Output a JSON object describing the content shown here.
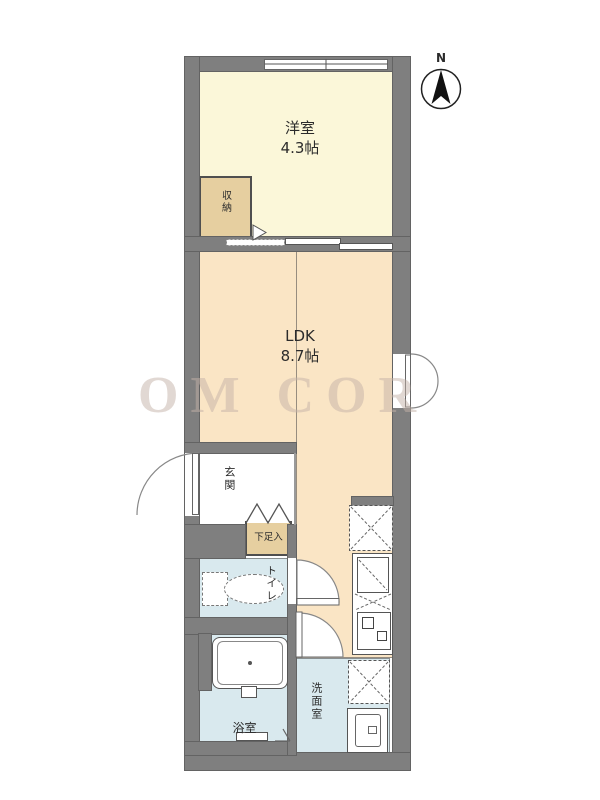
{
  "title": "apartment-floor-plan",
  "compass": {
    "north_label": "N"
  },
  "watermark": {
    "text": "OM COR"
  },
  "rooms": {
    "western_room": {
      "name": "洋室",
      "size": "4.3帖"
    },
    "ldk": {
      "name": "LDK",
      "size": "8.7帖"
    },
    "storage": {
      "name": "収納"
    },
    "shoe_box": {
      "name": "下足入"
    },
    "entrance": {
      "name": "玄関"
    },
    "toilet": {
      "name": "トイレ"
    },
    "bathroom": {
      "name": "浴室"
    },
    "washroom": {
      "name": "洗面室"
    }
  },
  "icons": [
    "compass-icon",
    "toilet-fixture",
    "bathtub-fixture",
    "kitchen-sink",
    "stove-fixture",
    "refrigerator-space",
    "washing-machine-space",
    "vanity-fixture",
    "door-swing",
    "window",
    "folding-door",
    "storage-door-marker"
  ],
  "colors": {
    "wall": "#7f7f7f",
    "western_room": "#FBF7D9",
    "ldk": "#FAE5C5",
    "storage": "#E6CFA0",
    "wet_area": "#D9E9EE",
    "watermark": "#C4B2A8"
  }
}
